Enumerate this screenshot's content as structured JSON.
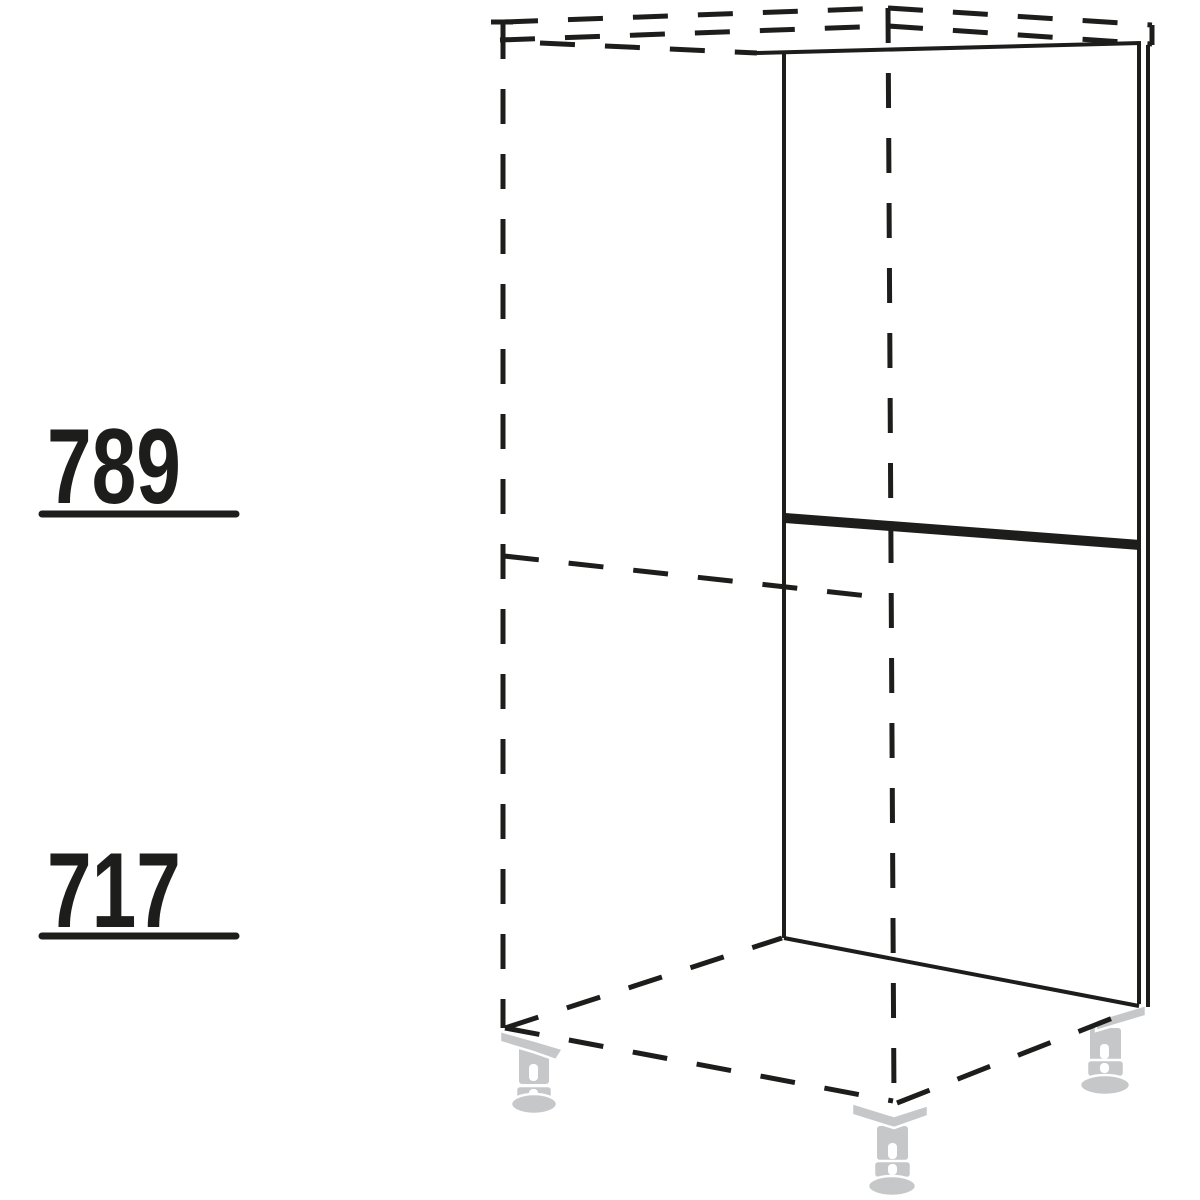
{
  "diagram": {
    "dimension_labels": [
      {
        "value": "789",
        "position": "upper"
      },
      {
        "value": "717",
        "position": "lower"
      }
    ],
    "feet_count": 3,
    "colors": {
      "line": "#1d1d1b",
      "foot": "#c5c7c9",
      "background": "#ffffff"
    }
  }
}
